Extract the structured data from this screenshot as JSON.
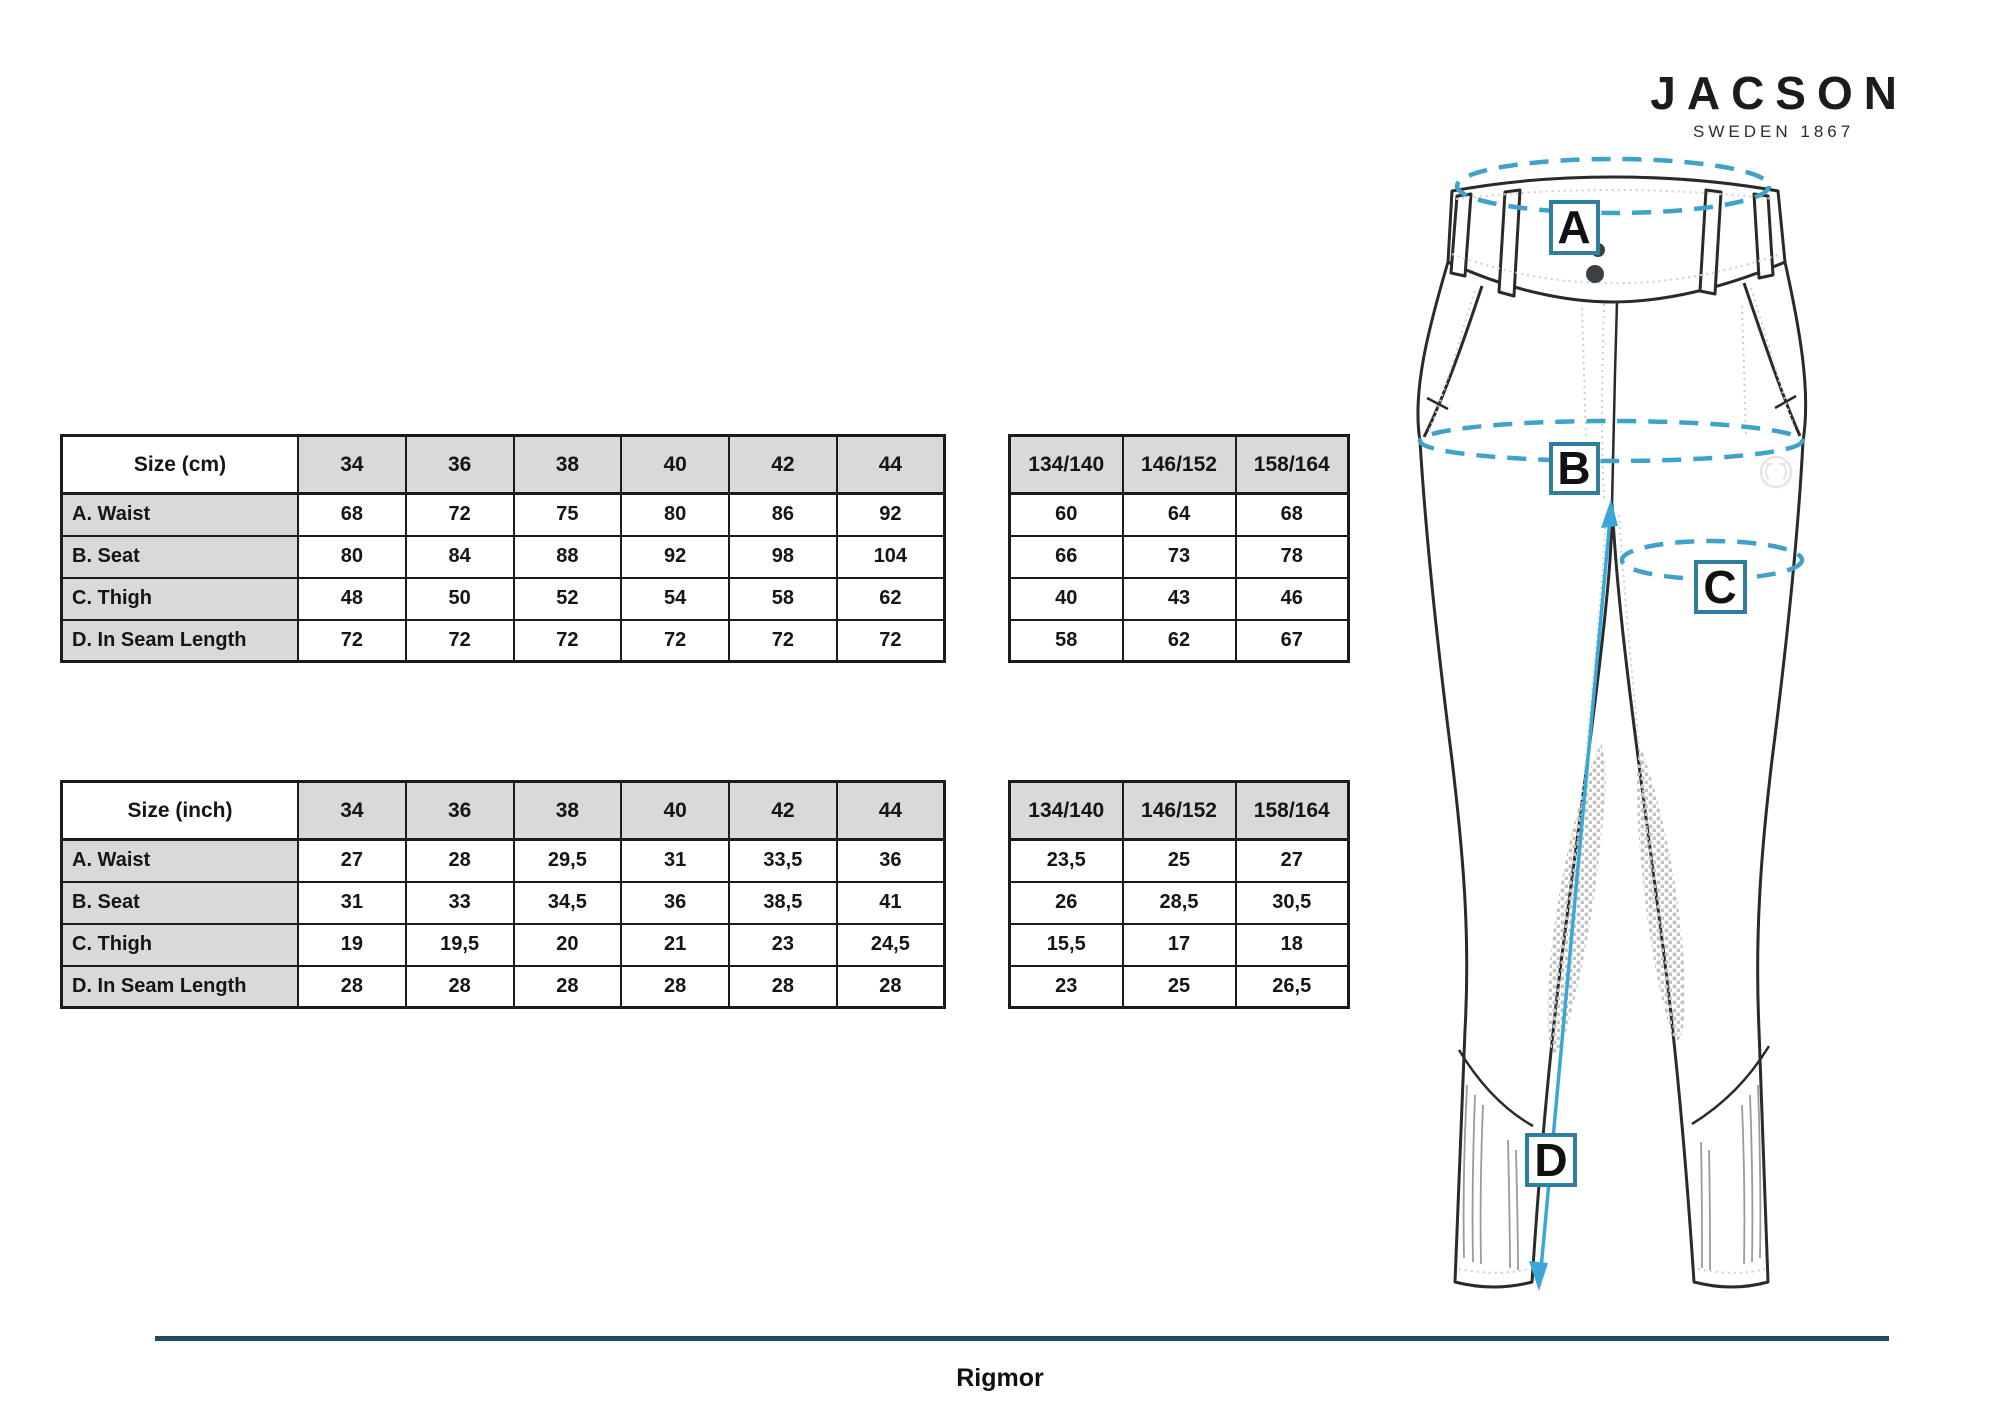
{
  "brand": {
    "name": "JACSON",
    "tagline": "SWEDEN 1867"
  },
  "product": {
    "name": "Rigmor"
  },
  "colors": {
    "accent_dashed": "#3ea2c9",
    "label_box_border": "#2e7f9f",
    "inseam_arrow": "#3ba7d9",
    "divider": "#1d4f5f",
    "table_header_bg": "#d9d9d9",
    "table_border": "#1b1b1b"
  },
  "figure_labels": {
    "a": "A",
    "b": "B",
    "c": "C",
    "d": "D"
  },
  "tables": {
    "cm": {
      "title": "Size (cm)",
      "columns": [
        "34",
        "36",
        "38",
        "40",
        "42",
        "44"
      ],
      "rows": [
        {
          "label": "A. Waist",
          "values": [
            "68",
            "72",
            "75",
            "80",
            "86",
            "92"
          ]
        },
        {
          "label": "B. Seat",
          "values": [
            "80",
            "84",
            "88",
            "92",
            "98",
            "104"
          ]
        },
        {
          "label": "C. Thigh",
          "values": [
            "48",
            "50",
            "52",
            "54",
            "58",
            "62"
          ]
        },
        {
          "label": "D. In Seam Length",
          "values": [
            "72",
            "72",
            "72",
            "72",
            "72",
            "72"
          ]
        }
      ]
    },
    "cm_kids": {
      "columns": [
        "134/140",
        "146/152",
        "158/164"
      ],
      "rows": [
        [
          "60",
          "64",
          "68"
        ],
        [
          "66",
          "73",
          "78"
        ],
        [
          "40",
          "43",
          "46"
        ],
        [
          "58",
          "62",
          "67"
        ]
      ]
    },
    "inch": {
      "title": "Size (inch)",
      "columns": [
        "34",
        "36",
        "38",
        "40",
        "42",
        "44"
      ],
      "rows": [
        {
          "label": "A. Waist",
          "values": [
            "27",
            "28",
            "29,5",
            "31",
            "33,5",
            "36"
          ]
        },
        {
          "label": "B. Seat",
          "values": [
            "31",
            "33",
            "34,5",
            "36",
            "38,5",
            "41"
          ]
        },
        {
          "label": "C. Thigh",
          "values": [
            "19",
            "19,5",
            "20",
            "21",
            "23",
            "24,5"
          ]
        },
        {
          "label": "D. In Seam Length",
          "values": [
            "28",
            "28",
            "28",
            "28",
            "28",
            "28"
          ]
        }
      ]
    },
    "inch_kids": {
      "columns": [
        "134/140",
        "146/152",
        "158/164"
      ],
      "rows": [
        [
          "23,5",
          "25",
          "27"
        ],
        [
          "26",
          "28,5",
          "30,5"
        ],
        [
          "15,5",
          "17",
          "18"
        ],
        [
          "23",
          "25",
          "26,5"
        ]
      ]
    }
  }
}
